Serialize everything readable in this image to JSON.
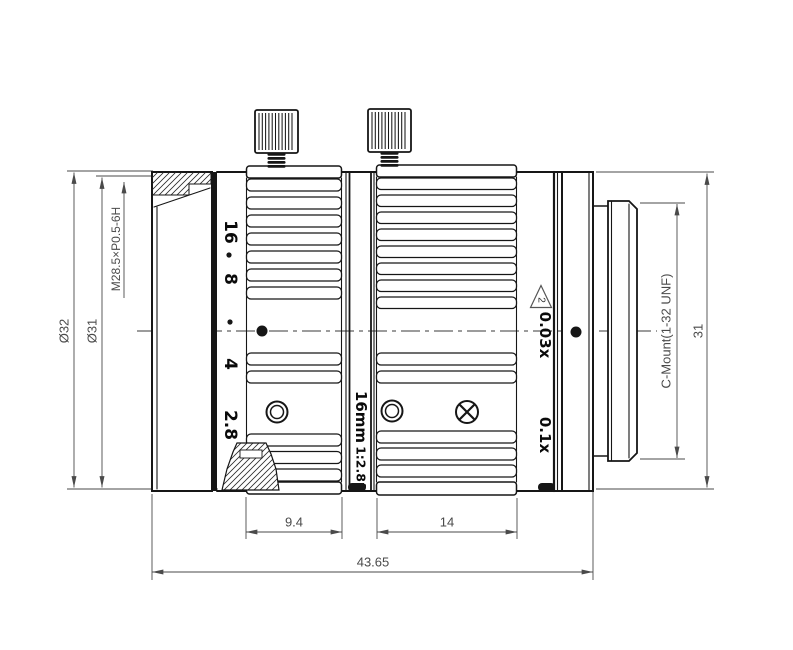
{
  "drawing": {
    "title": "c-mount-lens-outline-drawing",
    "dims": {
      "dia_outer": "Ø32",
      "dia_front": "Ø31",
      "front_thread": "M28.5×P0.5-6H",
      "mount": "C-Mount(1-32 UNF)",
      "rear_dia": "31",
      "aperture_ring_w": "9.4",
      "focus_ring_w": "14",
      "total_len": "43.65"
    },
    "markings": {
      "aperture": [
        "16",
        "8",
        "4",
        "2.8"
      ],
      "focal": "16mm",
      "fnum": "1:2.8",
      "fsuffix": "f",
      "note_num": "2",
      "mag_min": "0.03x",
      "mag_max": "0.1x"
    },
    "colors": {
      "line": "#161616",
      "dimension": "#4a4a4a",
      "background": "#ffffff"
    }
  }
}
